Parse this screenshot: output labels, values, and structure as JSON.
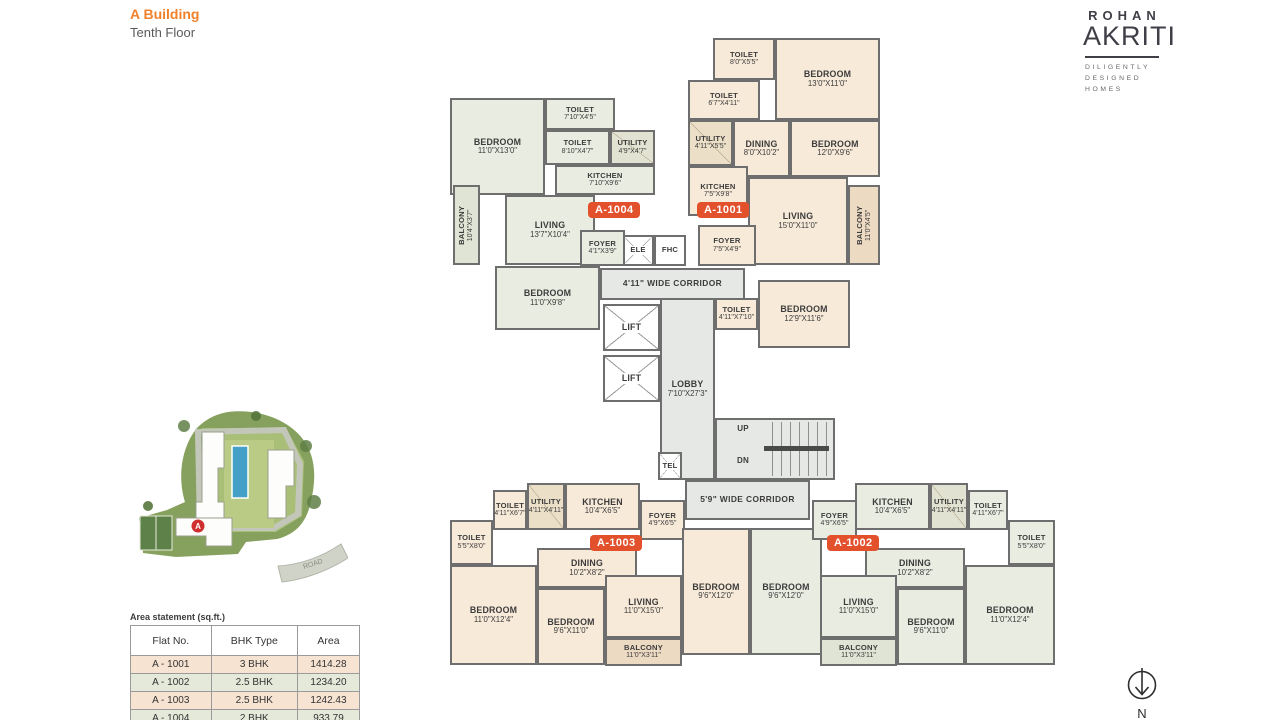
{
  "header": {
    "building": "A Building",
    "floor": "Tenth Floor"
  },
  "logo": {
    "brand": "ROHAN",
    "name": "AKRITI",
    "tagline_line1": "DILIGENTLY",
    "tagline_line2": "DESIGNED HOMES"
  },
  "colors": {
    "wall": "#6e6e6e",
    "peach": "#f8ead9",
    "green": "#e9ece1",
    "gray": "#e6e8e5",
    "white": "#ffffff",
    "balconyPeach": "#eddac3",
    "balconyGreen": "#dfe4d4",
    "utilPeach": "#ecdfc8",
    "utilGreen": "#e2e2d2",
    "badge": "#e2502c",
    "accentOrange": "#f0812a",
    "rowPeach": "#f7e3d1",
    "rowGreen": "#e5e9da"
  },
  "area_table": {
    "title": "Area statement (sq.ft.)",
    "headers": [
      "Flat No.",
      "BHK Type",
      "Area"
    ],
    "rows": [
      {
        "flat": "A - 1001",
        "type": "3 BHK",
        "area": "1414.28",
        "tint": "peach"
      },
      {
        "flat": "A - 1002",
        "type": "2.5 BHK",
        "area": "1234.20",
        "tint": "green"
      },
      {
        "flat": "A - 1003",
        "type": "2.5 BHK",
        "area": "1242.43",
        "tint": "peach"
      },
      {
        "flat": "A - 1004",
        "type": "2 BHK",
        "area": "933.79",
        "tint": "green"
      }
    ]
  },
  "north": {
    "label": "N"
  },
  "site_map": {
    "road_label": "ROAD",
    "marker_label": "A"
  },
  "plan": {
    "rooms": [
      {
        "id": "corridor-upper",
        "name": "4'11\" WIDE CORRIDOR",
        "x": 160,
        "y": 238,
        "w": 145,
        "h": 32,
        "fill": "gray",
        "cls": "cor"
      },
      {
        "id": "lobby",
        "name": "LOBBY",
        "dims": "7'10\"X27'3\"",
        "x": 220,
        "y": 268,
        "w": 55,
        "h": 182,
        "fill": "gray"
      },
      {
        "id": "stairwell",
        "x": 275,
        "y": 388,
        "w": 120,
        "h": 62,
        "fill": "gray",
        "cls": "stairs"
      },
      {
        "id": "corridor-lower",
        "name": "5'9\" WIDE CORRIDOR",
        "x": 245,
        "y": 450,
        "w": 125,
        "h": 40,
        "fill": "gray",
        "cls": "cor"
      },
      {
        "id": "lift-1",
        "name": "LIFT",
        "x": 163,
        "y": 274,
        "w": 57,
        "h": 47,
        "fill": "white",
        "cls": "xbox"
      },
      {
        "id": "lift-2",
        "name": "LIFT",
        "x": 163,
        "y": 325,
        "w": 57,
        "h": 47,
        "fill": "white",
        "cls": "xbox"
      },
      {
        "id": "elevator-shaft",
        "name": "ELE",
        "x": 182,
        "y": 205,
        "w": 32,
        "h": 31,
        "fill": "white",
        "cls": "xbox tinylbl"
      },
      {
        "id": "fire-hose-cabinet",
        "name": "FHC",
        "x": 214,
        "y": 205,
        "w": 32,
        "h": 31,
        "fill": "white",
        "cls": "tinylbl"
      },
      {
        "id": "telephone-shaft",
        "name": "TEL",
        "x": 218,
        "y": 422,
        "w": 24,
        "h": 28,
        "fill": "white",
        "cls": "xbox tinylbl"
      },
      {
        "id": "stairs-up-label",
        "name": "UP",
        "x": 290,
        "y": 392,
        "w": 26,
        "h": 13,
        "cls": "plain"
      },
      {
        "id": "stairs-dn-label",
        "name": "DN",
        "x": 290,
        "y": 424,
        "w": 26,
        "h": 13,
        "cls": "plain"
      },
      {
        "id": "a1004-bedroom-1",
        "name": "BEDROOM",
        "dims": "11'0\"X13'0\"",
        "x": 10,
        "y": 68,
        "w": 95,
        "h": 97,
        "fill": "green"
      },
      {
        "id": "a1004-toilet-1",
        "name": "TOILET",
        "dims": "7'10\"X4'5\"",
        "x": 105,
        "y": 68,
        "w": 70,
        "h": 32,
        "fill": "green",
        "cls": "tinylbl"
      },
      {
        "id": "a1004-toilet-2",
        "name": "TOILET",
        "dims": "8'10\"X4'7\"",
        "x": 105,
        "y": 100,
        "w": 65,
        "h": 35,
        "fill": "green",
        "cls": "tinylbl"
      },
      {
        "id": "a1004-utility",
        "name": "UTILITY",
        "dims": "4'9\"X4'7\"",
        "x": 170,
        "y": 100,
        "w": 45,
        "h": 35,
        "fill": "utilGreen",
        "cls": "hatch tinylbl"
      },
      {
        "id": "a1004-kitchen",
        "name": "KITCHEN",
        "dims": "7'10\"X9'6\"",
        "x": 115,
        "y": 135,
        "w": 100,
        "h": 30,
        "fill": "green",
        "cls": "tinylbl"
      },
      {
        "id": "a1004-living",
        "name": "LIVING",
        "dims": "13'7\"X10'4\"",
        "x": 65,
        "y": 165,
        "w": 90,
        "h": 70,
        "fill": "green"
      },
      {
        "id": "a1004-balcony",
        "name": "BALCONY",
        "dims": "10'4\"X3'7\"",
        "x": 13,
        "y": 155,
        "w": 27,
        "h": 80,
        "fill": "balconyGreen",
        "cls": "vert tinylbl"
      },
      {
        "id": "a1004-foyer",
        "name": "FOYER",
        "dims": "4'1\"X3'9\"",
        "x": 140,
        "y": 200,
        "w": 45,
        "h": 36,
        "fill": "green",
        "cls": "tinylbl"
      },
      {
        "id": "a1004-bedroom-2",
        "name": "BEDROOM",
        "dims": "11'0\"X9'8\"",
        "x": 55,
        "y": 236,
        "w": 105,
        "h": 64,
        "fill": "green"
      },
      {
        "id": "a1001-toilet-1",
        "name": "TOILET",
        "dims": "8'0\"X5'5\"",
        "x": 273,
        "y": 8,
        "w": 62,
        "h": 42,
        "fill": "peach",
        "cls": "tinylbl"
      },
      {
        "id": "a1001-bedroom-1",
        "name": "BEDROOM",
        "dims": "13'0\"X11'0\"",
        "x": 335,
        "y": 8,
        "w": 105,
        "h": 82,
        "fill": "peach"
      },
      {
        "id": "a1001-toilet-2",
        "name": "TOILET",
        "dims": "6'7\"X4'11\"",
        "x": 248,
        "y": 50,
        "w": 72,
        "h": 40,
        "fill": "peach",
        "cls": "tinylbl"
      },
      {
        "id": "a1001-utility",
        "name": "UTILITY",
        "dims": "4'11\"X5'5\"",
        "x": 248,
        "y": 90,
        "w": 45,
        "h": 46,
        "fill": "utilPeach",
        "cls": "hatch tinylbl"
      },
      {
        "id": "a1001-dining",
        "name": "DINING",
        "dims": "8'0\"X10'2\"",
        "x": 293,
        "y": 90,
        "w": 57,
        "h": 57,
        "fill": "peach"
      },
      {
        "id": "a1001-bedroom-2",
        "name": "BEDROOM",
        "dims": "12'0\"X9'6\"",
        "x": 350,
        "y": 90,
        "w": 90,
        "h": 57,
        "fill": "peach"
      },
      {
        "id": "a1001-kitchen",
        "name": "KITCHEN",
        "dims": "7'5\"X9'8\"",
        "x": 248,
        "y": 136,
        "w": 60,
        "h": 50,
        "fill": "peach",
        "cls": "tinylbl"
      },
      {
        "id": "a1001-living",
        "name": "LIVING",
        "dims": "15'0\"X11'0\"",
        "x": 308,
        "y": 147,
        "w": 100,
        "h": 88,
        "fill": "peach"
      },
      {
        "id": "a1001-balcony",
        "name": "BALCONY",
        "dims": "11'0\"X4'5\"",
        "x": 408,
        "y": 155,
        "w": 32,
        "h": 80,
        "fill": "balconyPeach",
        "cls": "vert tinylbl"
      },
      {
        "id": "a1001-foyer",
        "name": "FOYER",
        "dims": "7'5\"X4'9\"",
        "x": 258,
        "y": 195,
        "w": 58,
        "h": 41,
        "fill": "peach",
        "cls": "tinylbl"
      },
      {
        "id": "a1001-toilet-3",
        "name": "TOILET",
        "dims": "4'11\"X7'10\"",
        "x": 275,
        "y": 268,
        "w": 43,
        "h": 32,
        "fill": "peach",
        "cls": "tinylbl"
      },
      {
        "id": "a1001-bedroom-3",
        "name": "BEDROOM",
        "dims": "12'9\"X11'6\"",
        "x": 318,
        "y": 250,
        "w": 92,
        "h": 68,
        "fill": "peach"
      },
      {
        "id": "a1003-toilet-1",
        "name": "TOILET",
        "dims": "4'11\"X6'7\"",
        "x": 53,
        "y": 460,
        "w": 34,
        "h": 40,
        "fill": "peach",
        "cls": "tinylbl"
      },
      {
        "id": "a1003-utility",
        "name": "UTILITY",
        "dims": "4'11\"X4'11\"",
        "x": 87,
        "y": 453,
        "w": 38,
        "h": 47,
        "fill": "utilPeach",
        "cls": "hatch tinylbl"
      },
      {
        "id": "a1003-kitchen",
        "name": "KITCHEN",
        "dims": "10'4\"X6'5\"",
        "x": 125,
        "y": 453,
        "w": 75,
        "h": 47,
        "fill": "peach"
      },
      {
        "id": "a1003-foyer",
        "name": "FOYER",
        "dims": "4'9\"X6'5\"",
        "x": 200,
        "y": 470,
        "w": 45,
        "h": 40,
        "fill": "peach",
        "cls": "tinylbl"
      },
      {
        "id": "a1003-toilet-2",
        "name": "TOILET",
        "dims": "5'5\"X8'0\"",
        "x": 10,
        "y": 490,
        "w": 43,
        "h": 45,
        "fill": "peach",
        "cls": "tinylbl"
      },
      {
        "id": "a1003-dining",
        "name": "DINING",
        "dims": "10'2\"X8'2\"",
        "x": 97,
        "y": 518,
        "w": 100,
        "h": 40,
        "fill": "peach"
      },
      {
        "id": "a1003-bedroom-1",
        "name": "BEDROOM",
        "dims": "11'0\"X12'4\"",
        "x": 10,
        "y": 535,
        "w": 87,
        "h": 100,
        "fill": "peach"
      },
      {
        "id": "a1003-bedroom-2",
        "name": "BEDROOM",
        "dims": "9'6\"X11'0\"",
        "x": 97,
        "y": 558,
        "w": 68,
        "h": 77,
        "fill": "peach"
      },
      {
        "id": "a1003-living",
        "name": "LIVING",
        "dims": "11'0\"X15'0\"",
        "x": 165,
        "y": 545,
        "w": 77,
        "h": 63,
        "fill": "peach"
      },
      {
        "id": "a1003-balcony",
        "name": "BALCONY",
        "dims": "11'0\"X3'11\"",
        "x": 165,
        "y": 608,
        "w": 77,
        "h": 28,
        "fill": "balconyPeach",
        "cls": "tinylbl"
      },
      {
        "id": "a1003-bedroom-3",
        "name": "BEDROOM",
        "dims": "9'6\"X12'0\"",
        "x": 242,
        "y": 498,
        "w": 68,
        "h": 127,
        "fill": "peach"
      },
      {
        "id": "a1002-bedroom-3",
        "name": "BEDROOM",
        "dims": "9'6\"X12'0\"",
        "x": 310,
        "y": 498,
        "w": 72,
        "h": 127,
        "fill": "green"
      },
      {
        "id": "a1002-foyer",
        "name": "FOYER",
        "dims": "4'9\"X6'5\"",
        "x": 372,
        "y": 470,
        "w": 45,
        "h": 40,
        "fill": "green",
        "cls": "tinylbl"
      },
      {
        "id": "a1002-kitchen",
        "name": "KITCHEN",
        "dims": "10'4\"X6'5\"",
        "x": 415,
        "y": 453,
        "w": 75,
        "h": 47,
        "fill": "green"
      },
      {
        "id": "a1002-utility",
        "name": "UTILITY",
        "dims": "4'11\"X4'11\"",
        "x": 490,
        "y": 453,
        "w": 38,
        "h": 47,
        "fill": "utilGreen",
        "cls": "hatch tinylbl"
      },
      {
        "id": "a1002-toilet-1",
        "name": "TOILET",
        "dims": "4'11\"X6'7\"",
        "x": 528,
        "y": 460,
        "w": 40,
        "h": 40,
        "fill": "green",
        "cls": "tinylbl"
      },
      {
        "id": "a1002-toilet-2",
        "name": "TOILET",
        "dims": "5'5\"X8'0\"",
        "x": 568,
        "y": 490,
        "w": 47,
        "h": 45,
        "fill": "green",
        "cls": "tinylbl"
      },
      {
        "id": "a1002-dining",
        "name": "DINING",
        "dims": "10'2\"X8'2\"",
        "x": 425,
        "y": 518,
        "w": 100,
        "h": 40,
        "fill": "green"
      },
      {
        "id": "a1002-living",
        "name": "LIVING",
        "dims": "11'0\"X15'0\"",
        "x": 380,
        "y": 545,
        "w": 77,
        "h": 63,
        "fill": "green"
      },
      {
        "id": "a1002-balcony",
        "name": "BALCONY",
        "dims": "11'0\"X3'11\"",
        "x": 380,
        "y": 608,
        "w": 77,
        "h": 28,
        "fill": "balconyGreen",
        "cls": "tinylbl"
      },
      {
        "id": "a1002-bedroom-2",
        "name": "BEDROOM",
        "dims": "9'6\"X11'0\"",
        "x": 457,
        "y": 558,
        "w": 68,
        "h": 77,
        "fill": "green"
      },
      {
        "id": "a1002-bedroom-1",
        "name": "BEDROOM",
        "dims": "11'0\"X12'4\"",
        "x": 525,
        "y": 535,
        "w": 90,
        "h": 100,
        "fill": "green"
      }
    ],
    "badges": [
      {
        "id": "unit-badge-a1004",
        "label": "A-1004",
        "x": 148,
        "y": 172
      },
      {
        "id": "unit-badge-a1001",
        "label": "A-1001",
        "x": 257,
        "y": 172
      },
      {
        "id": "unit-badge-a1003",
        "label": "A-1003",
        "x": 150,
        "y": 505
      },
      {
        "id": "unit-badge-a1002",
        "label": "A-1002",
        "x": 387,
        "y": 505
      }
    ]
  }
}
